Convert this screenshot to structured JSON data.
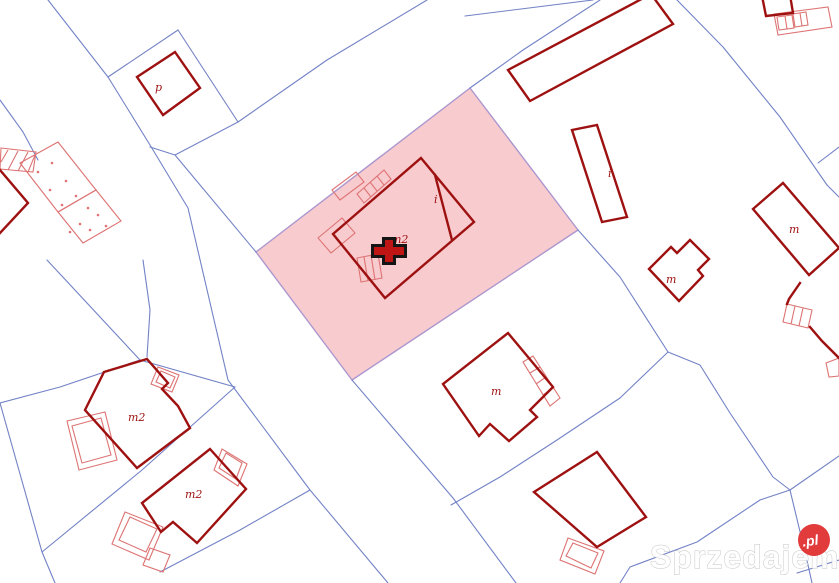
{
  "watermark": {
    "text": "Sprzedajemy",
    "badge_text": ".pl",
    "badge_color": "#e23b3b",
    "text_color": "#ffffff"
  },
  "colors": {
    "background": "#ffffff",
    "parcel_line": "#7282c6",
    "highlight_fill": "#f8cbcf",
    "highlight_stroke": "#ab97ce",
    "building_stroke": "#9e1111",
    "annex_stroke": "#dd7373",
    "label_color": "#9e1111",
    "marker_outer": "#151515",
    "marker_inner": "#bf1515"
  },
  "map": {
    "highlight_parcel": {
      "pts": "470,88 578,230 352,380 256,252"
    },
    "marker": {
      "x": 389,
      "y": 251,
      "outer_path": "M382,237 h14 v7 h11 v14 h-11 v7 h-14 v-7 h-11 v-14 h11 z",
      "inner_path": "M385,240 h8 v7 h11 v8 h-11 v7 h-8 v-7 h-11 v-8 h11 z"
    },
    "parcel_lines": [
      {
        "pts": "48,0 108,77 150,145 188,208 228,380 310,490 388,583"
      },
      {
        "pts": "108,77 178,30"
      },
      {
        "pts": "178,30 238,122"
      },
      {
        "pts": "427,0 327,60 238,122 175,155 150,147"
      },
      {
        "pts": "175,155 256,252"
      },
      {
        "pts": "352,380 453,498 516,583"
      },
      {
        "pts": "47,260 140,360 235,387"
      },
      {
        "pts": "143,260 150,310 147,357"
      },
      {
        "pts": "140,360 60,387 0,403"
      },
      {
        "pts": "0,403 42,552 55,583"
      },
      {
        "pts": "235,387 142,470 42,552"
      },
      {
        "pts": "310,490 240,530 200,551 160,572"
      },
      {
        "pts": "470,88 523,50 600,0"
      },
      {
        "pts": "465,16 593,0"
      },
      {
        "pts": "677,0 723,47 780,117 827,185 839,197"
      },
      {
        "pts": "818,163 839,147"
      },
      {
        "pts": "578,230 620,277 668,352"
      },
      {
        "pts": "668,352 620,398 557,440 500,477 451,505"
      },
      {
        "pts": "668,352 700,365 730,413 773,477 790,490"
      },
      {
        "pts": "790,490 839,456"
      },
      {
        "pts": "790,490 808,565 812,583"
      },
      {
        "pts": "620,583 630,567 697,542 760,500 790,490"
      },
      {
        "pts": "797,573 839,560"
      },
      {
        "pts": "0,100 23,132 38,160"
      }
    ],
    "buildings": [
      {
        "pts": "175,52 200,88 163,115 137,77",
        "closed": true
      },
      {
        "pts": "508,70 530,101 673,24 651,-6",
        "closed": true
      },
      {
        "pts": "572,130 597,125 627,217 602,222",
        "closed": true
      },
      {
        "pts": "421,158 474,222 385,298 333,234",
        "closed": true
      },
      {
        "pts": "435,175 452,240",
        "closed": false
      },
      {
        "pts": "508,333 553,387 530,410 537,417 509,441 490,424 479,436 443,384",
        "closed": true
      },
      {
        "pts": "597,452 646,517 597,547 534,492",
        "closed": true
      },
      {
        "pts": "147,359 168,383 162,389 178,406 190,428 137,468 85,410 104,372",
        "closed": true
      },
      {
        "pts": "210,449 246,489 197,543 173,522 161,532 142,503",
        "closed": true
      },
      {
        "pts": "649,269 671,247 677,253 690,240 709,259 698,270 703,276 679,301",
        "closed": true
      },
      {
        "pts": "753,209 783,183 839,248 809,275",
        "closed": true
      },
      {
        "pts": "800,283 789,299 787,304",
        "closed": false
      },
      {
        "pts": "810,327 822,341 839,358",
        "closed": false
      },
      {
        "pts": "0,170 28,203 0,233",
        "closed": false
      },
      {
        "pts": "763,1 766,16 793,13 791,1",
        "closed": false
      }
    ],
    "light_shapes": [
      {
        "pts": "357,194 384,170 391,179 364,203",
        "closed": true
      },
      {
        "pts": "364,188 371,197",
        "closed": false
      },
      {
        "pts": "370,182 377,191",
        "closed": false
      },
      {
        "pts": "377,176 384,185",
        "closed": false
      },
      {
        "pts": "332,190 356,172 364,182 340,200",
        "closed": true
      },
      {
        "pts": "318,238 342,218 355,233 331,253",
        "closed": true
      },
      {
        "pts": "357,258 378,254 382,278 361,282",
        "closed": true
      },
      {
        "pts": "364,257 368,281",
        "closed": false
      },
      {
        "pts": "371,255 375,280",
        "closed": false
      },
      {
        "pts": "523,362 533,356 560,398 550,406",
        "closed": true
      },
      {
        "pts": "530,373 540,367",
        "closed": false
      },
      {
        "pts": "536,384 546,377",
        "closed": false
      },
      {
        "pts": "543,395 553,388",
        "closed": false
      },
      {
        "pts": "787,304 812,310 808,328 783,322",
        "closed": true
      },
      {
        "pts": "795,306 791,324",
        "closed": false
      },
      {
        "pts": "803,308 799,326",
        "closed": false
      },
      {
        "pts": "826,363 839,358 839,376 829,377",
        "closed": true
      },
      {
        "pts": "774,14 828,7 832,27 778,35",
        "closed": true
      },
      {
        "pts": "777,17 792,15 794,28 779,30",
        "closed": true
      },
      {
        "pts": "785,16 787,29",
        "closed": false
      },
      {
        "pts": "793,14 806,12 808,25 795,27",
        "closed": true
      },
      {
        "pts": "800,13 802,26",
        "closed": false
      },
      {
        "pts": "1,148 36,152 33,172 0,169",
        "closed": true
      },
      {
        "pts": "8,150 1,162",
        "closed": false
      },
      {
        "pts": "18,151 8,170",
        "closed": false
      },
      {
        "pts": "28,152 18,171",
        "closed": false
      },
      {
        "pts": "35,155 28,172",
        "closed": false
      },
      {
        "pts": "20,163 58,142 96,190 58,212",
        "closed": true
      },
      {
        "pts": "58,212 96,190 121,221 83,243",
        "closed": true
      },
      {
        "pts": "158,367 179,375 172,392 151,384",
        "closed": true
      },
      {
        "pts": "161,371 175,377 170,388 156,382",
        "closed": true
      },
      {
        "pts": "67,421 105,412 117,460 79,470",
        "closed": true
      },
      {
        "pts": "72,426 101,418 111,455 82,463",
        "closed": true
      },
      {
        "pts": "222,449 247,464 238,486 214,470",
        "closed": true
      },
      {
        "pts": "226,453 242,463 236,479 219,468",
        "closed": true
      },
      {
        "pts": "125,512 163,527 149,560 112,544",
        "closed": true
      },
      {
        "pts": "130,517 157,529 146,552 119,540",
        "closed": true
      },
      {
        "pts": "150,548 170,555 163,572 143,565",
        "closed": true
      },
      {
        "pts": "568,538 604,551 595,574 560,560",
        "closed": true
      },
      {
        "pts": "573,543 598,553 591,568 566,556",
        "closed": true
      }
    ],
    "dots": [
      {
        "x": 38,
        "y": 172
      },
      {
        "x": 52,
        "y": 163
      },
      {
        "x": 66,
        "y": 181
      },
      {
        "x": 50,
        "y": 190
      },
      {
        "x": 76,
        "y": 196
      },
      {
        "x": 62,
        "y": 205
      },
      {
        "x": 88,
        "y": 208
      },
      {
        "x": 98,
        "y": 215
      },
      {
        "x": 106,
        "y": 226
      },
      {
        "x": 80,
        "y": 224
      },
      {
        "x": 70,
        "y": 232
      },
      {
        "x": 90,
        "y": 230
      }
    ],
    "labels": [
      {
        "text": "p",
        "x": 155,
        "y": 91
      },
      {
        "text": "m2",
        "x": 391,
        "y": 243
      },
      {
        "text": "i",
        "x": 434,
        "y": 203
      },
      {
        "text": "i",
        "x": 608,
        "y": 177
      },
      {
        "text": "m",
        "x": 666,
        "y": 283
      },
      {
        "text": "m",
        "x": 789,
        "y": 233
      },
      {
        "text": "m",
        "x": 491,
        "y": 395
      },
      {
        "text": "m2",
        "x": 128,
        "y": 421
      },
      {
        "text": "m2",
        "x": 185,
        "y": 498
      }
    ]
  }
}
